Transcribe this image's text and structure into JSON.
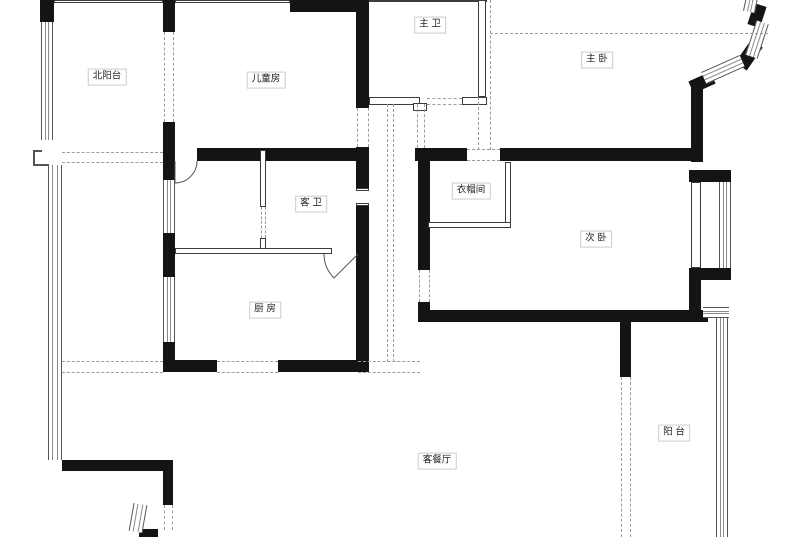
{
  "floorplan": {
    "rooms": {
      "north_balcony": "北阳台",
      "kids_room": "儿童房",
      "master_bath": "主 卫",
      "master_bedroom": "主 卧",
      "guest_bath": "客 卫",
      "cloakroom": "衣帽间",
      "second_bedroom": "次 卧",
      "kitchen": "厨 房",
      "living_dining": "客餐厅",
      "balcony": "阳 台"
    },
    "colors": {
      "wall": "#141414",
      "thin_line": "#555555",
      "dashed_line": "#9c9c9c",
      "background": "#ffffff",
      "label_border": "#cccccc"
    }
  }
}
